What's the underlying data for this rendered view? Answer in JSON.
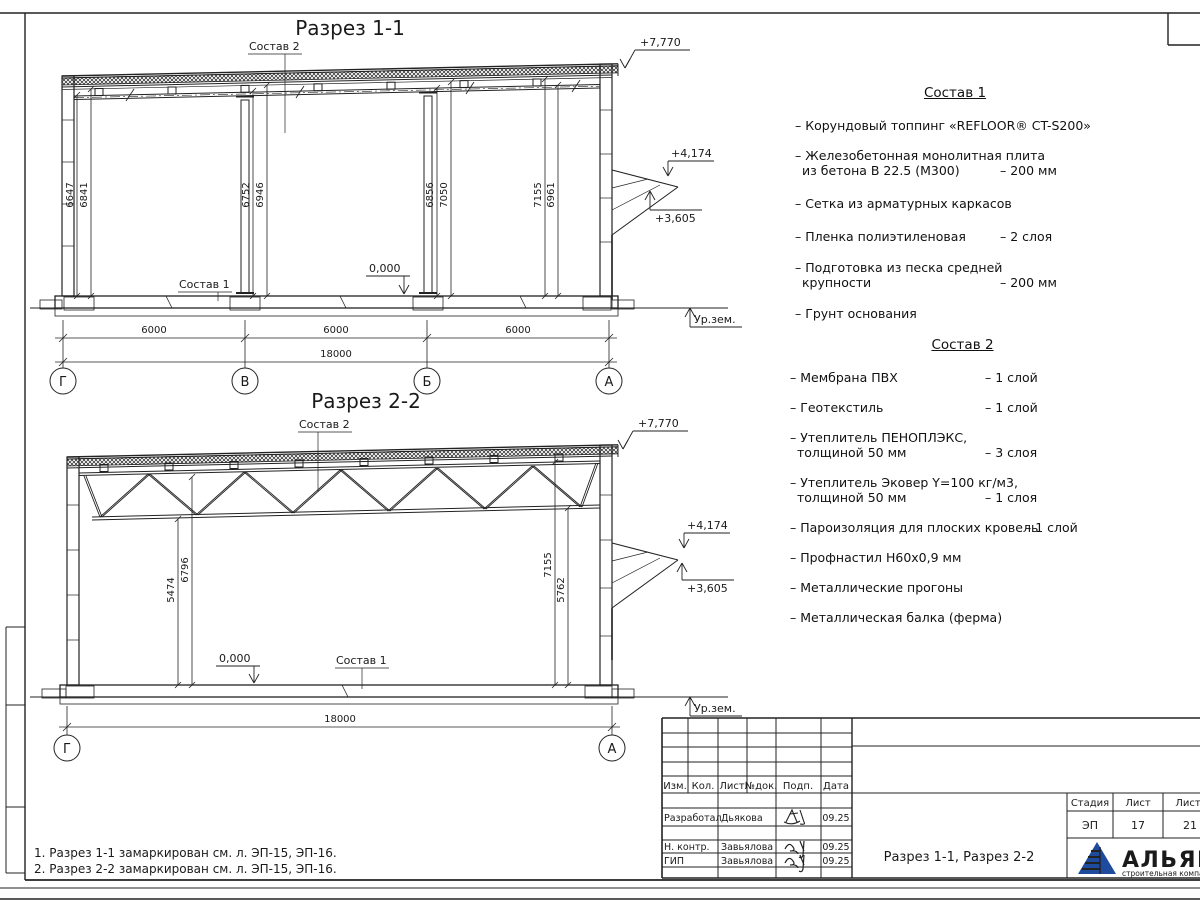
{
  "s1": {
    "title": "Разрез 1-1",
    "sostav2_label": "Состав 2",
    "sostav1_label": "Состав 1",
    "elev7": "+7,770",
    "elev4": "+4,174",
    "elev3": "+3,605",
    "elev0": "0,000",
    "ground": "Ур.зем.",
    "dim_l1": "6647",
    "dim_l2": "6841",
    "dim_v1": "6752",
    "dim_v2": "6946",
    "dim_b1": "6856",
    "dim_b2": "7050",
    "dim_r1": "7155",
    "dim_r2": "6961",
    "span1": "6000",
    "span2": "6000",
    "span3": "6000",
    "total": "18000",
    "ax1": "Г",
    "ax2": "В",
    "ax3": "Б",
    "ax4": "А"
  },
  "s2": {
    "title": "Разрез 2-2",
    "sostav2_label": "Состав 2",
    "sostav1_label": "Состав 1",
    "elev7": "+7,770",
    "elev4": "+4,174",
    "elev3": "+3,605",
    "elev0": "0,000",
    "ground": "Ур.зем.",
    "dim_l1": "5474",
    "dim_l2": "6796",
    "dim_r1": "7155",
    "dim_r2": "5762",
    "total": "18000",
    "ax1": "Г",
    "ax2": "А"
  },
  "sostav1": {
    "title": "Состав 1",
    "items": [
      {
        "l1": "– Корундовый топпинг «REFLOOR® CT-S200»",
        "l2": "",
        "val": ""
      },
      {
        "l1": "– Железобетонная  монолитная плита",
        "l2": "из бетона В 22.5 (М300)",
        "val": "– 200 мм"
      },
      {
        "l1": "– Сетка из арматурных каркасов",
        "l2": "",
        "val": ""
      },
      {
        "l1": "– Пленка полиэтиленовая",
        "l2": "",
        "val": "– 2 слоя"
      },
      {
        "l1": "– Подготовка из песка средней",
        "l2": "крупности",
        "val": "– 200 мм"
      },
      {
        "l1": "– Грунт основания",
        "l2": "",
        "val": ""
      }
    ]
  },
  "sostav2": {
    "title": "Состав 2",
    "items": [
      {
        "l1": "– Мембрана ПВХ",
        "l2": "",
        "val": "– 1 слой"
      },
      {
        "l1": "– Геотекстиль",
        "l2": "",
        "val": "– 1 слой"
      },
      {
        "l1": "– Утеплитель ПЕНОПЛЭКС,",
        "l2": "толщиной 50 мм",
        "val": "– 3 слоя"
      },
      {
        "l1": "– Утеплитель Эковер Y=100 кг/м3,",
        "l2": "толщиной 50 мм",
        "val": "– 1 слоя"
      },
      {
        "l1": "– Пароизоляция для плоских кровель",
        "l2": "",
        "val": "– 1 слой"
      },
      {
        "l1": "– Профнастил Н60х0,9 мм",
        "l2": "",
        "val": ""
      },
      {
        "l1": "– Металлические прогоны",
        "l2": "",
        "val": ""
      },
      {
        "l1": "– Металлическая балка (ферма)",
        "l2": "",
        "val": ""
      }
    ]
  },
  "notes": {
    "n1": "1. Разрез 1-1 замаркирован см. л. ЭП-15, ЭП-16.",
    "n2": "2. Разрез 2-2 замаркирован см. л. ЭП-15, ЭП-16."
  },
  "stamp": {
    "h_izm": "Изм.",
    "h_kol": "Кол.",
    "h_list": "Лист",
    "h_doc": "№док.",
    "h_podp": "Подп.",
    "h_data": "Дата",
    "r1_role": "Разработал",
    "r1_name": "Дьякова",
    "r1_date": "09.25",
    "r2_role": "Н. контр.",
    "r2_name": "Завьялова",
    "r2_date": "09.25",
    "r3_role": "ГИП",
    "r3_name": "Завьялова",
    "r3_date": "09.25",
    "doc_title": "Разрез 1-1, Разрез 2-2",
    "stage_h": "Стадия",
    "list_h": "Лист",
    "listov_h": "Листов",
    "stage": "ЭП",
    "list": "17",
    "listov": "21",
    "company": "АЛЬЯНС",
    "company_sub": "строительная компания",
    "logo_color": "#1e4b9e",
    "company_color": "#21409a",
    "company_sub_color": "#3a6fb5"
  }
}
